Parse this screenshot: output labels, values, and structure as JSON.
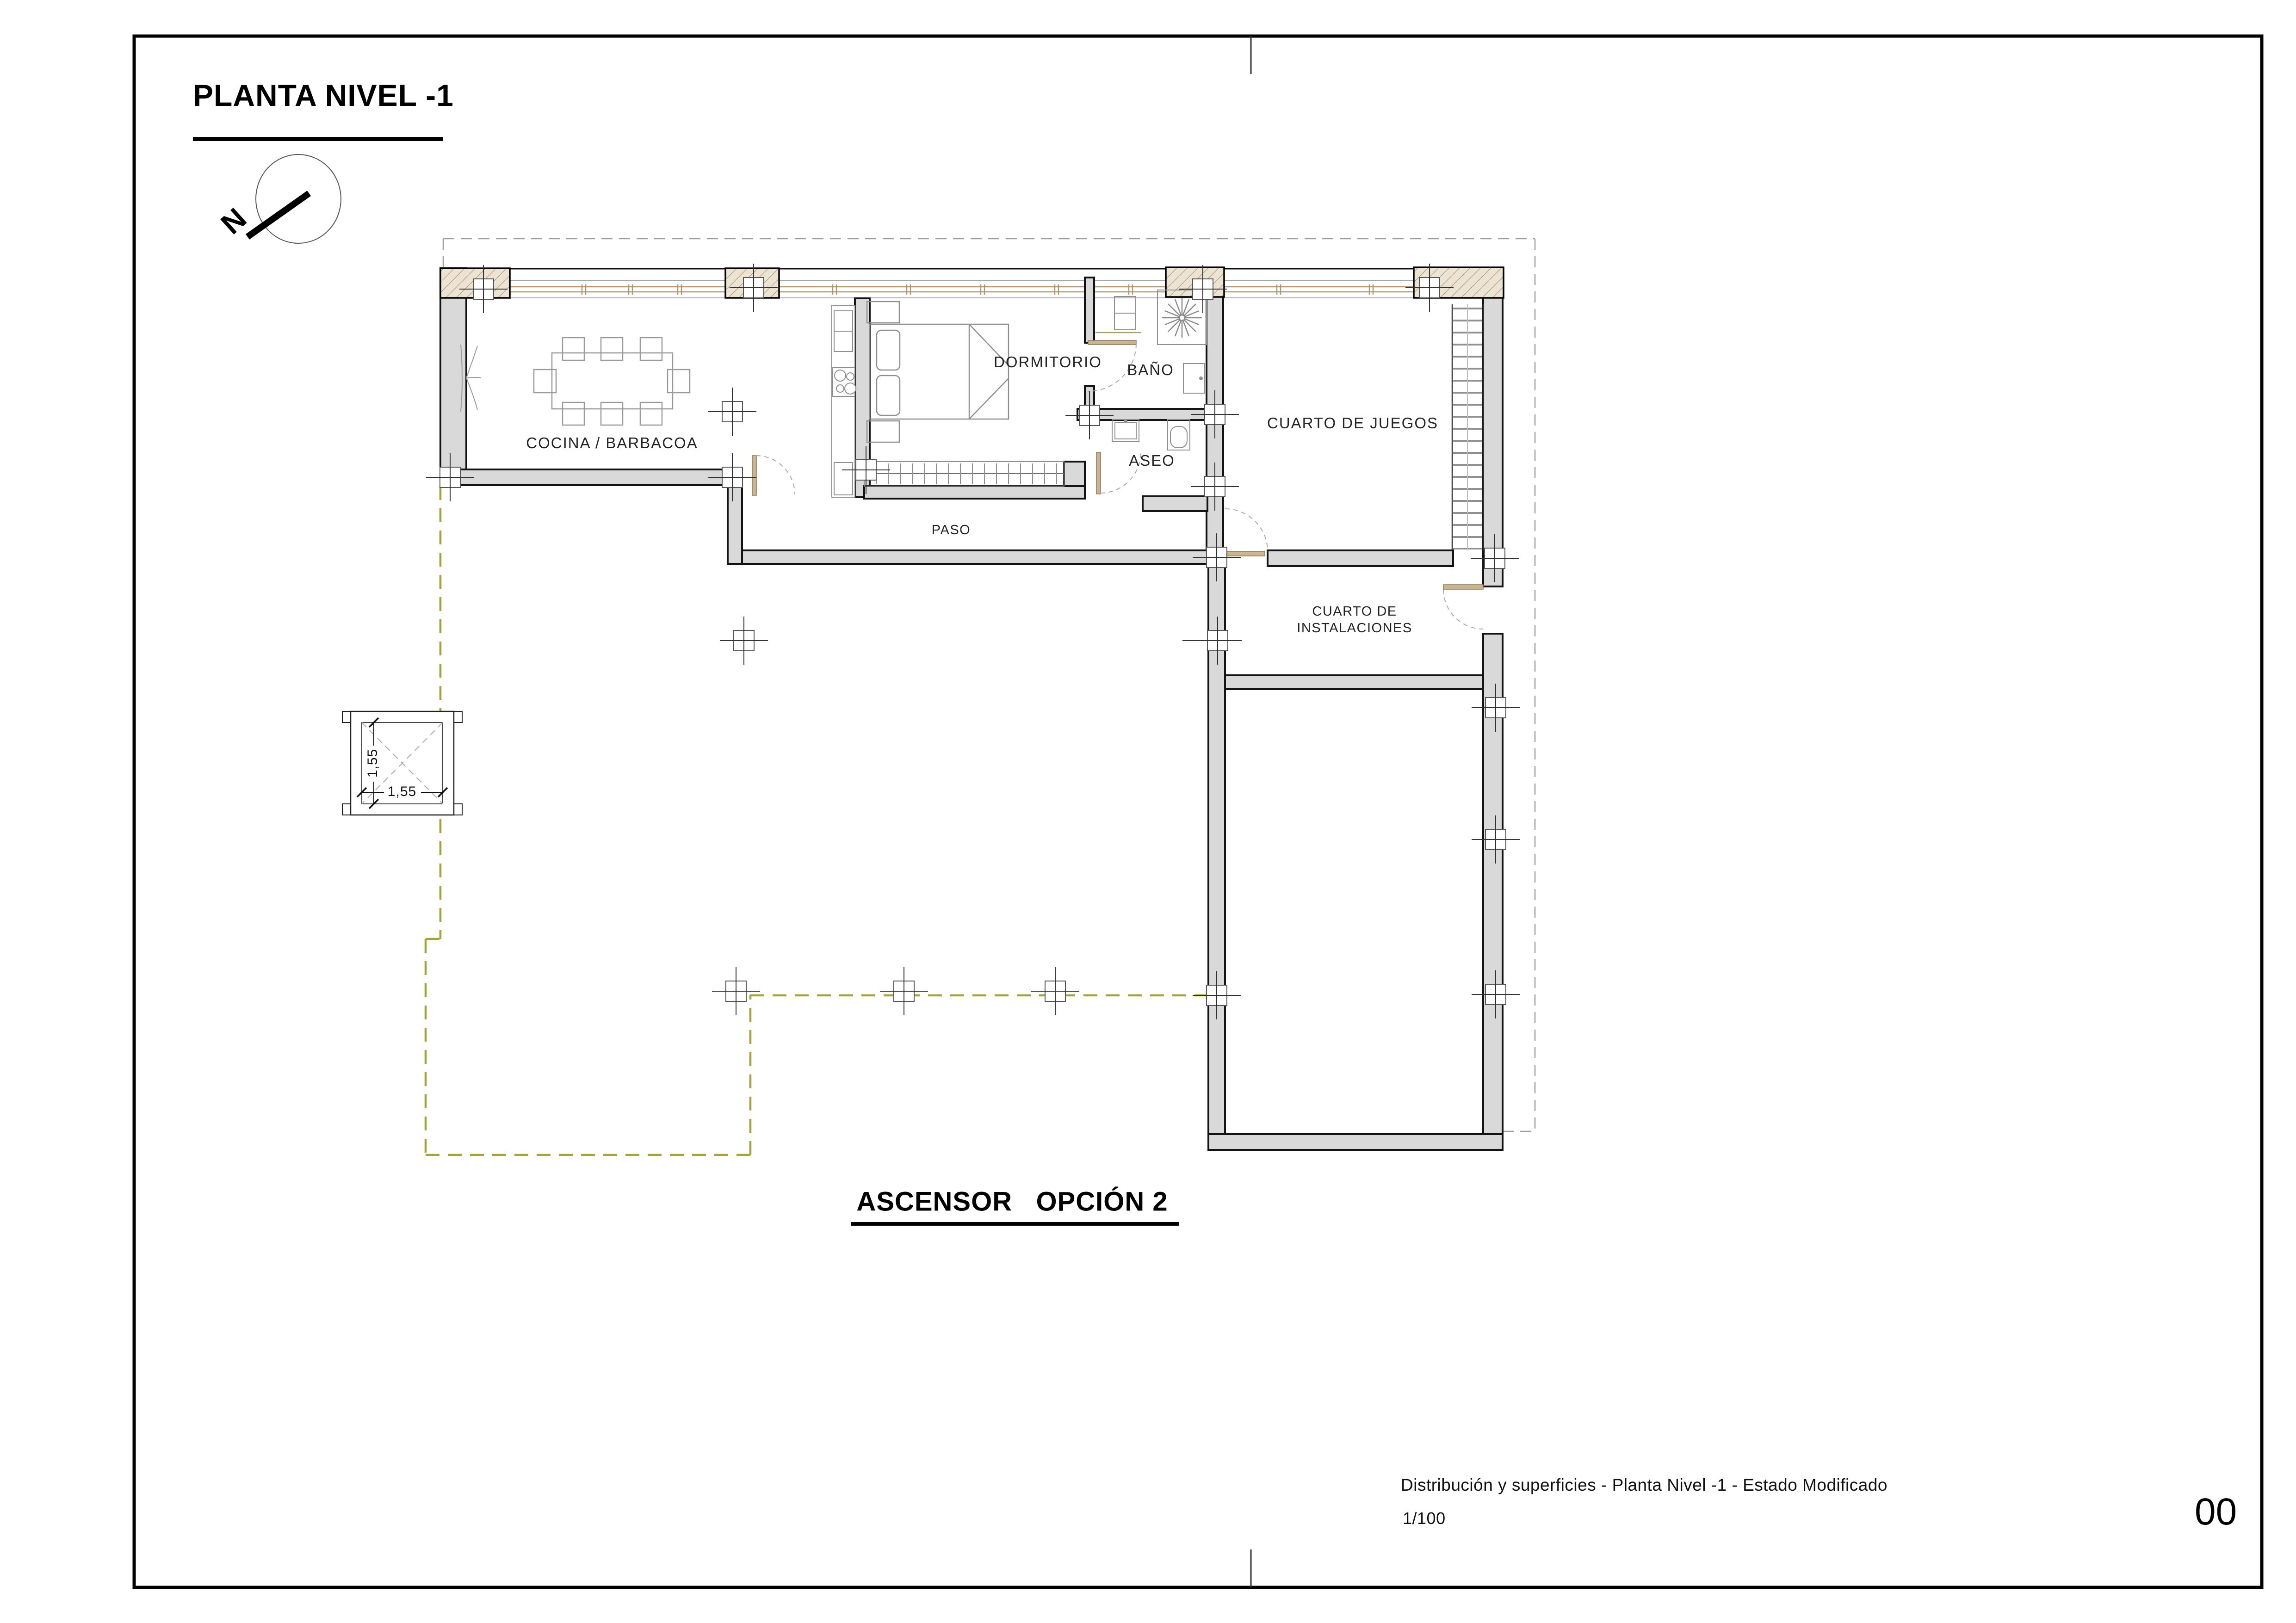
{
  "sheet": {
    "title": "PLANTA NIVEL -1",
    "caption": "ASCENSOR   OPCIÓN 2",
    "north_label": "N"
  },
  "labels": {
    "kitchen": "COCINA / BARBACOA",
    "bedroom": "DORMITORIO",
    "bathroom": "BAÑO",
    "toilet": "ASEO",
    "hallway": "PASO",
    "playroom": "CUARTO DE JUEGOS",
    "utility_line1": "CUARTO DE",
    "utility_line2": "INSTALACIONES"
  },
  "dimensions": {
    "elevator_width": "1,55",
    "elevator_depth": "1,55"
  },
  "title_block": {
    "description": "Distribución y superficies - Planta Nivel -1 - Estado Modificado",
    "scale": "1/100",
    "sheet_number": "00"
  },
  "colors": {
    "wall_fill": "#d9d9d9",
    "pier_fill": "#ece3d2",
    "window_wood": "#b29772",
    "roof_dash": "#9d9d9d",
    "terrace_dash": "#a4a23d"
  }
}
